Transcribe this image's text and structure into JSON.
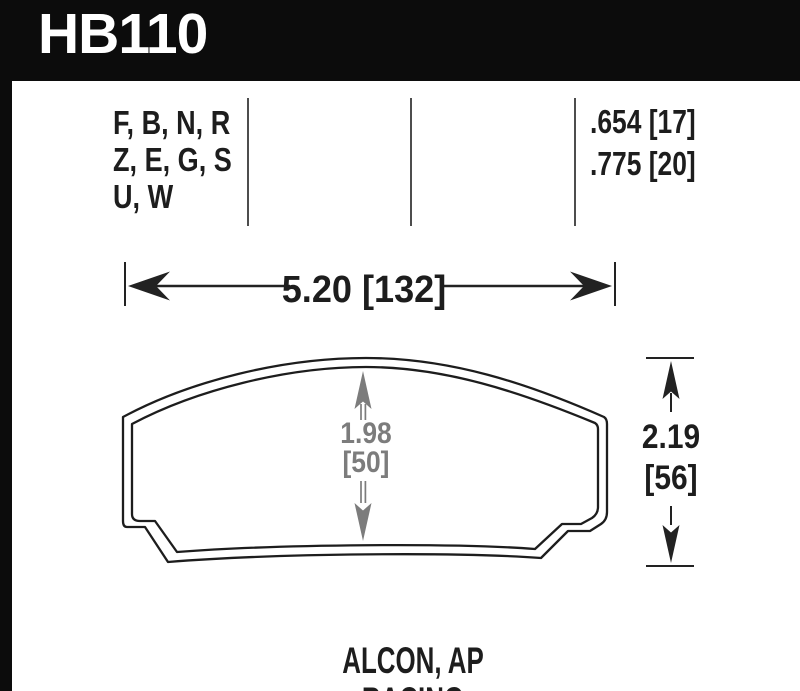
{
  "header": {
    "part_number": "HB110"
  },
  "spec_table": {
    "compounds": [
      "F, B, N, R",
      "Z, E, G, S",
      "U, W"
    ],
    "pad_thickness": [
      ".654 [17]",
      ".775 [20]"
    ]
  },
  "dimensions": {
    "width": "5.20 [132]",
    "friction_height": [
      "1.98",
      "[50]"
    ],
    "overall_height": [
      "2.19",
      "[56]"
    ]
  },
  "caption": "ALCON, AP RACING",
  "colors": {
    "header_bg": "#0c0c0c",
    "ink": "#1d1d1d",
    "dim_gray": "#7c7c7c"
  }
}
